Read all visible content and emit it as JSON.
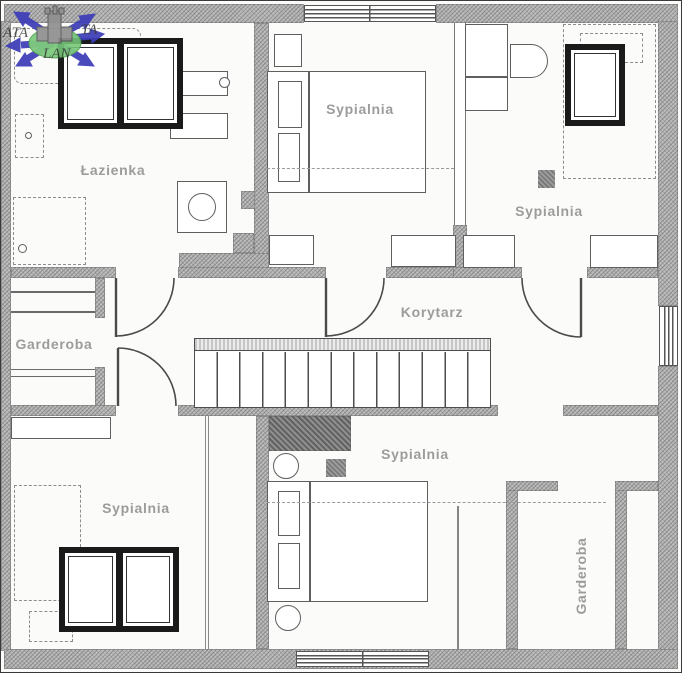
{
  "watermark": {
    "left_text": "ATA",
    "right_text": "TA",
    "bottom_text": "LAN"
  },
  "rooms": [
    {
      "id": "bathroom",
      "label": "Łazienka"
    },
    {
      "id": "bedroom_top_center",
      "label": "Sypialnia"
    },
    {
      "id": "bedroom_top_right",
      "label": "Sypialnia"
    },
    {
      "id": "wardrobe_left",
      "label": "Garderoba"
    },
    {
      "id": "corridor",
      "label": "Korytarz"
    },
    {
      "id": "bedroom_bottom_left",
      "label": "Sypialnia"
    },
    {
      "id": "bedroom_bottom_center",
      "label": "Sypialnia"
    },
    {
      "id": "wardrobe_bottom_right",
      "label": "Garderoba"
    }
  ],
  "colors": {
    "wall": "#bdbdbd",
    "wall_dark": "#8f8f8f",
    "line": "#4a4a4a",
    "furniture": "#5f5f5f",
    "label": "#8f8f8f",
    "background": "#fbfbf9",
    "watermark_blue": "#3d3db8",
    "watermark_green": "#74c674"
  }
}
